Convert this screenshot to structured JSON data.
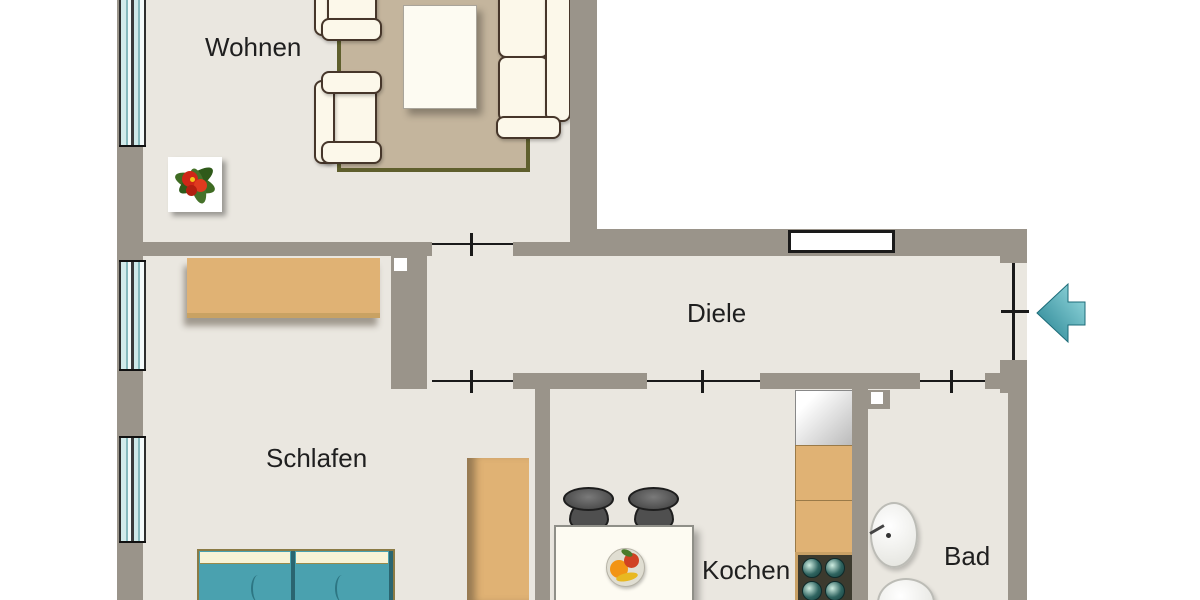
{
  "plan_title": "apartment-floor-plan",
  "rooms": {
    "wohnen": "Wohnen",
    "diele": "Diele",
    "schlafen": "Schlafen",
    "kochen": "Kochen",
    "bad": "Bad"
  },
  "entrance": {
    "direction": "left"
  },
  "counts": {
    "windows_visible": 3,
    "door_openings": 5
  },
  "colors": {
    "wall": "#9a948a",
    "floor": "#eae7e0",
    "window_glass": "#b9d8da",
    "rug": "#c4b59d",
    "rug_border": "#5f5f2d",
    "wood_furniture": "#e0b274",
    "bed_teal": "#4aa1af",
    "upholstery_cream": "#fcf8ea",
    "entrance_arrow": "#3fa3b0",
    "stove_frame": "#c9a166"
  }
}
